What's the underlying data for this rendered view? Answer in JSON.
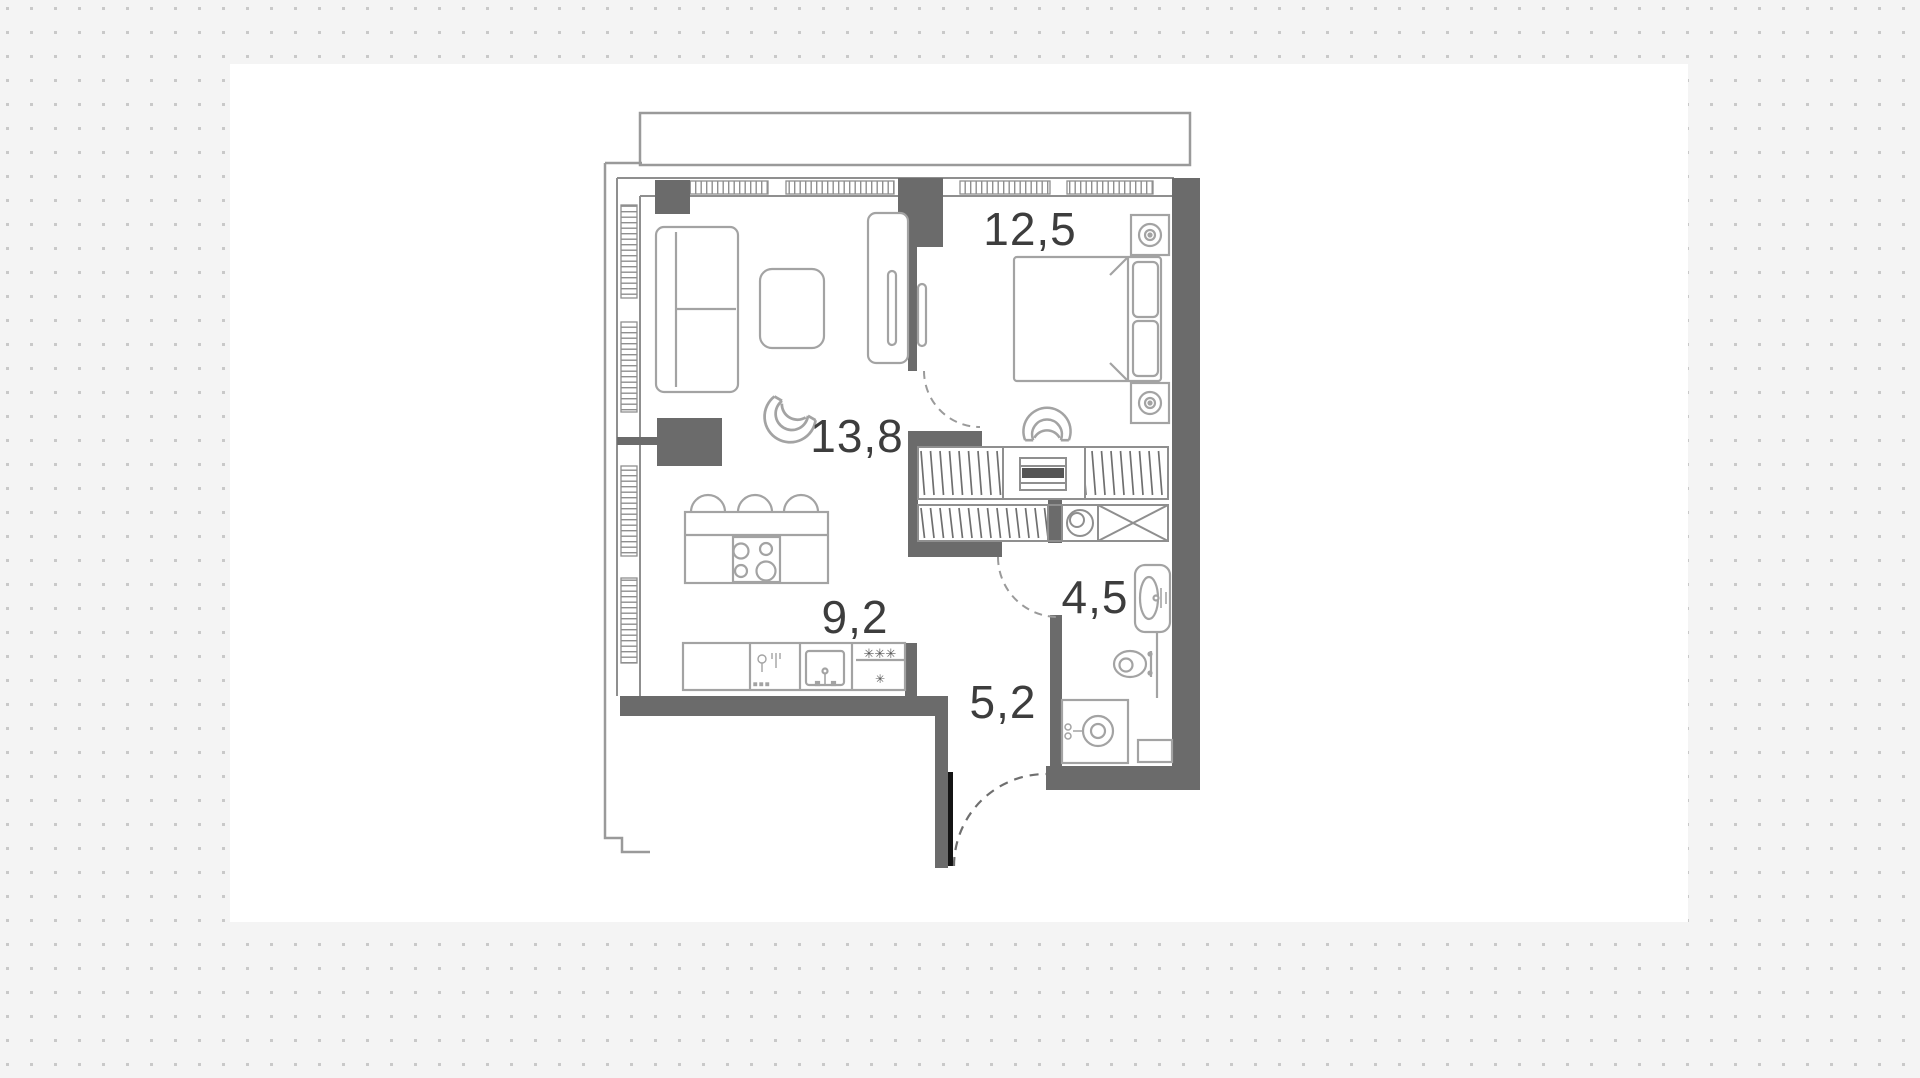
{
  "plan": {
    "type": "apartment-floor-plan",
    "rooms": [
      {
        "name": "living-room",
        "area_label": "13,8"
      },
      {
        "name": "bedroom",
        "area_label": "12,5"
      },
      {
        "name": "kitchen",
        "area_label": "9,2"
      },
      {
        "name": "bathroom",
        "area_label": "4,5"
      },
      {
        "name": "hallway",
        "area_label": "5,2"
      }
    ],
    "fridge": {
      "freezer_marks": "✳✳✳",
      "compartment_mark": "✳"
    },
    "colors": {
      "page_background": "#f4f4f4",
      "dot_grid": "#c9c9c9",
      "canvas": "#ffffff",
      "wall_dark": "#6b6b6b",
      "wall_medium": "#8f8f8f",
      "furniture_line": "#a3a3a3",
      "outer_contour": "#9a9a9a",
      "door_leaf": "#141414",
      "label_text": "#3d3d3d"
    }
  }
}
